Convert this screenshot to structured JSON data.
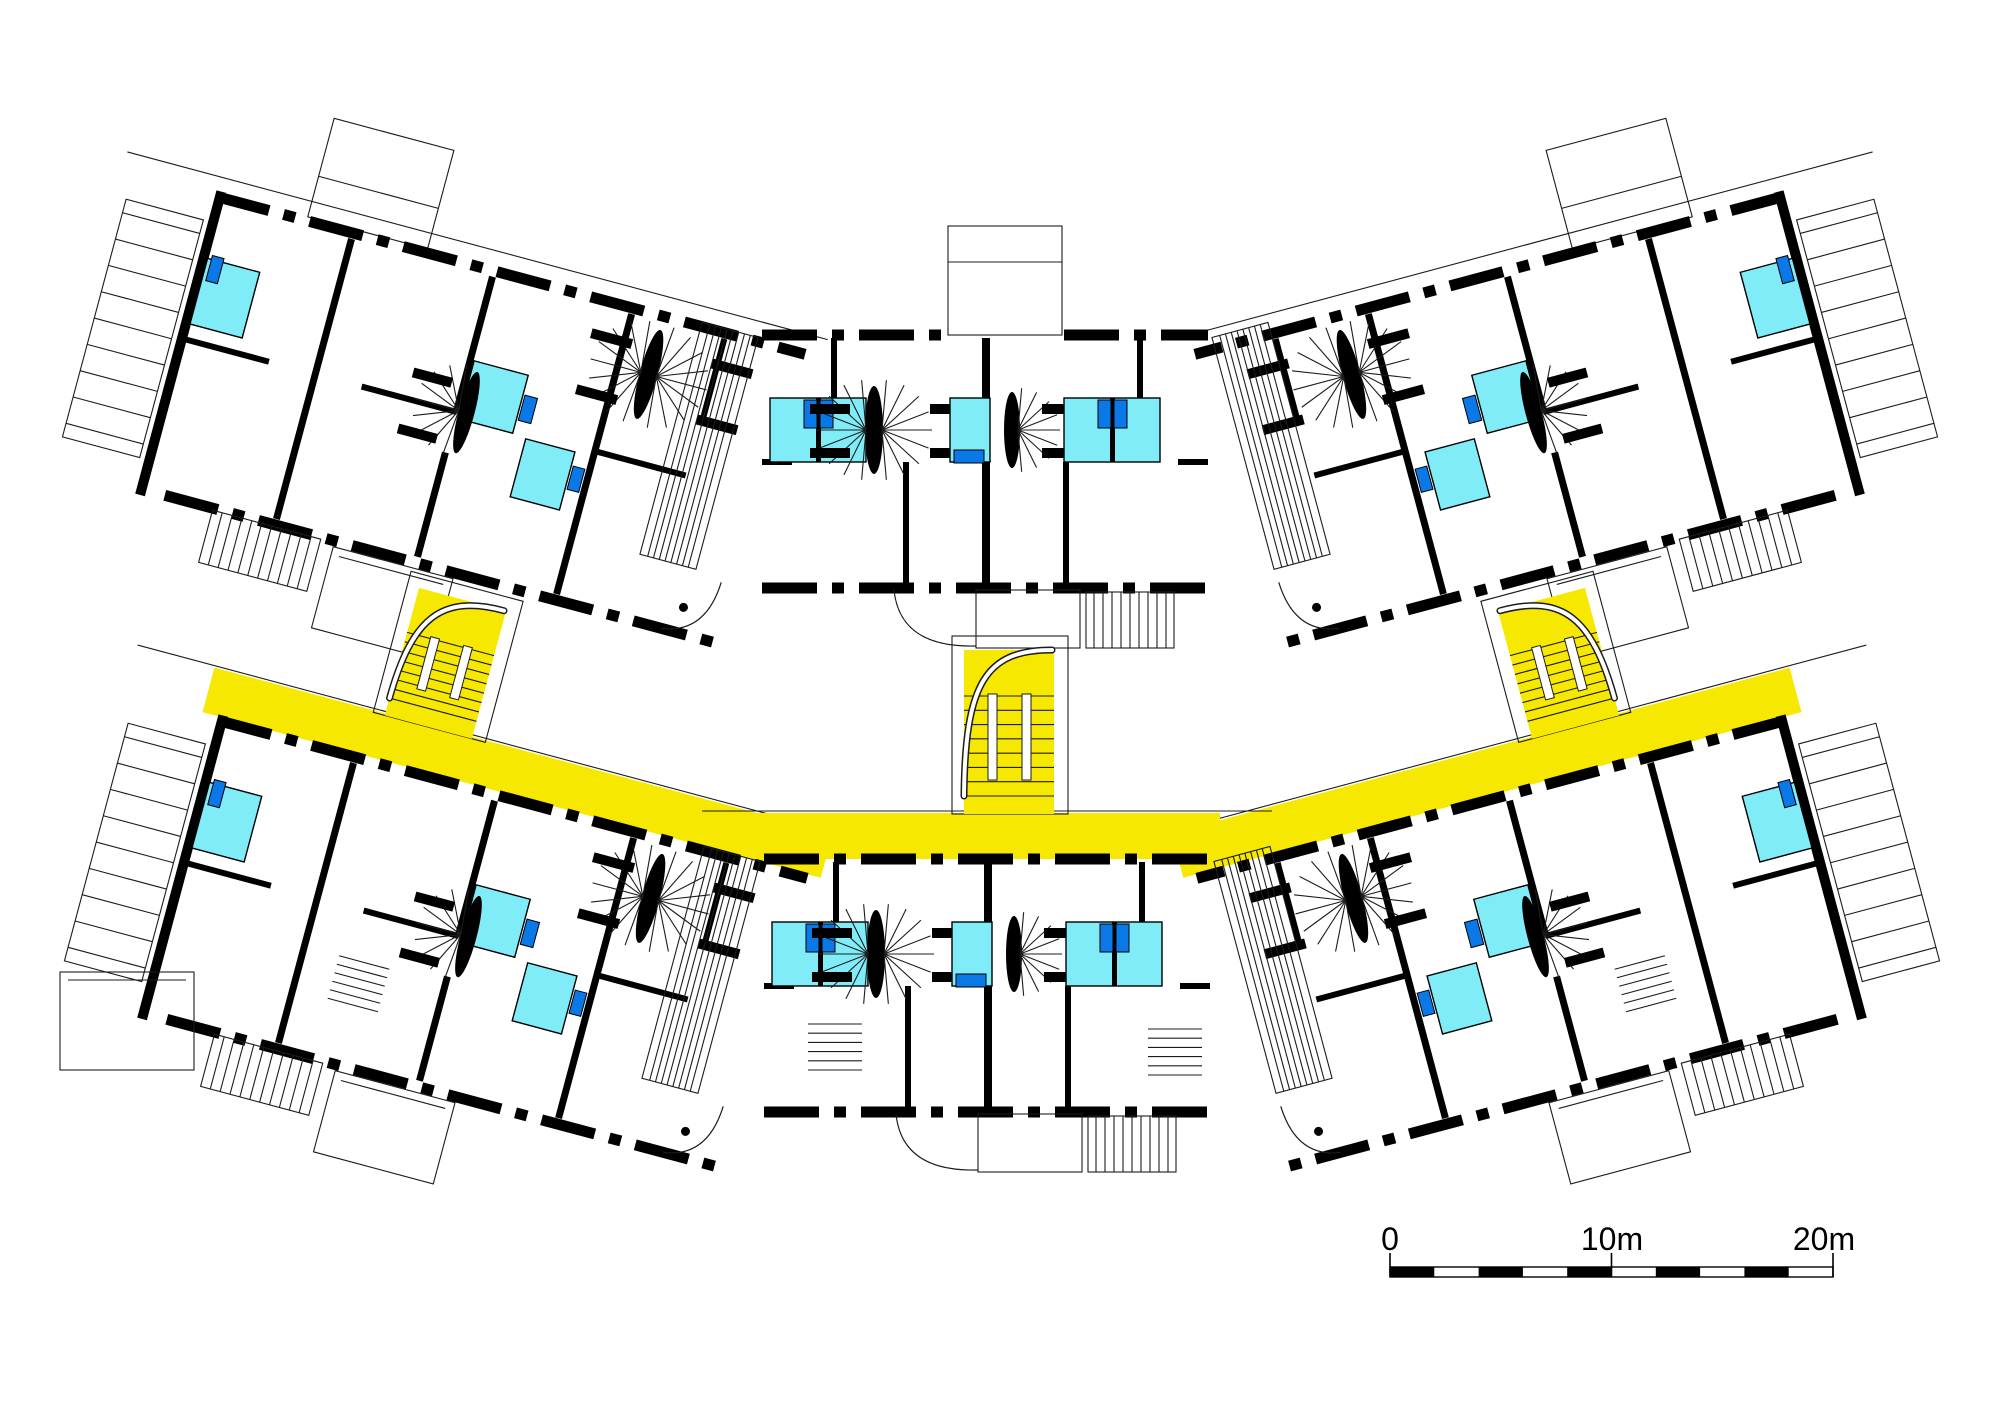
{
  "scale_bar": {
    "labels": [
      "0",
      "10m",
      "20m"
    ],
    "segment_count": 10,
    "meters_total": 20
  },
  "colors": {
    "background": "#ffffff",
    "wall": "#000000",
    "thin_line": "#1c1c1c",
    "outline_gray": "#8a8a8a",
    "wet_room": "#7fecf7",
    "fixture": "#0a78e6",
    "gallery": "#f6e800"
  }
}
